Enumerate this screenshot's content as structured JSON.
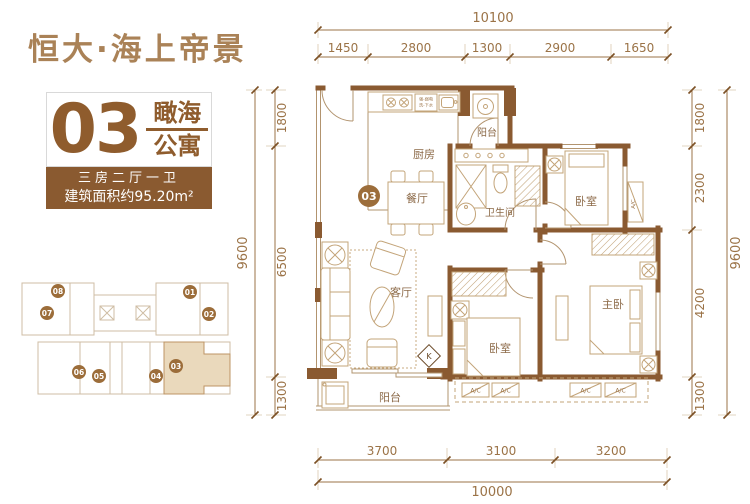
{
  "header": {
    "project_title": "恒大·海上帝景"
  },
  "unit_card": {
    "unit_number": "03",
    "unit_name_top": "瞰海",
    "unit_name_bottom": "公寓",
    "layout_text": "三房二厅一卫",
    "area_text": "建筑面积约95.20m²"
  },
  "floor_plan": {
    "unit_badge": "03",
    "rooms": {
      "kitchen": "厨房",
      "balcony_top": "阳台",
      "dining": "餐厅",
      "bathroom": "卫生间",
      "bedroom_top": "卧室",
      "living": "客厅",
      "bedroom_mid": "卧室",
      "master": "主卧",
      "balcony_bottom": "阳台"
    },
    "annotations": {
      "kitchen_note_line1": "强-弱电",
      "kitchen_note_line2": "洗-下水",
      "ac_label": "A/C",
      "door_k": "K"
    }
  },
  "dimensions": {
    "top": {
      "total": "10100",
      "segments": [
        "1450",
        "2800",
        "1300",
        "2900",
        "1650"
      ]
    },
    "bottom": {
      "total": "10000",
      "segments": [
        "3700",
        "3100",
        "3200"
      ]
    },
    "left": {
      "total": "9600",
      "segments": [
        "1800",
        "6500",
        "1300"
      ]
    },
    "right": {
      "total": "9600",
      "segments": [
        "1800",
        "2300",
        "4200",
        "1300"
      ]
    }
  },
  "key_plan": {
    "highlighted_unit": "03",
    "units": [
      "08",
      "07",
      "01",
      "02",
      "06",
      "05",
      "04",
      "03"
    ]
  },
  "colors": {
    "wall_brown": "#8a5a31",
    "accent_brown": "#9c6d3a",
    "dim_brown": "#9b7347",
    "bar_brown": "#8a5a30",
    "title_brown": "#aa8257",
    "highlight_tan": "#ead9bc"
  }
}
